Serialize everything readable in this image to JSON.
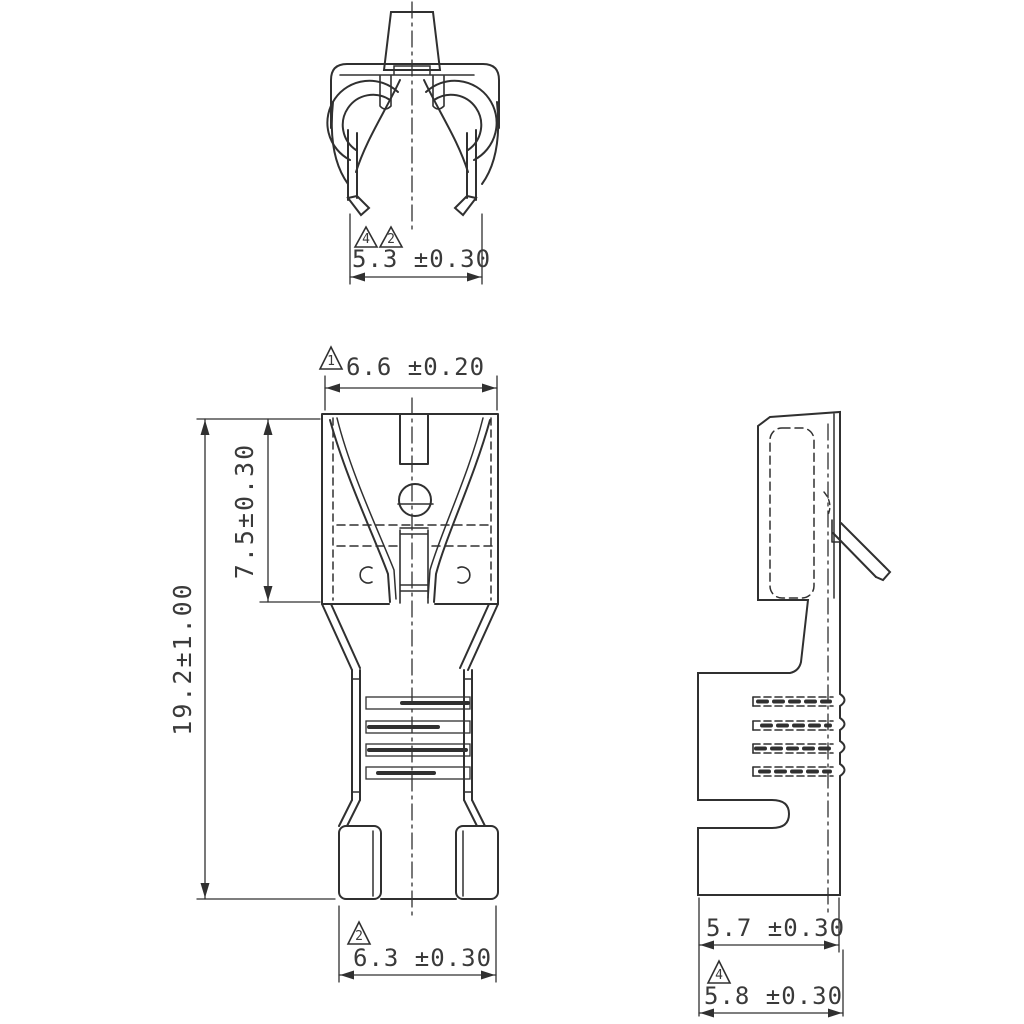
{
  "colors": {
    "background": "#ffffff",
    "line": "#303030",
    "text": "#3a3a3a"
  },
  "views": {
    "end_view": {
      "dim_width": {
        "text": "5.3 ±0.30",
        "flags": [
          "4",
          "2"
        ]
      }
    },
    "front_view": {
      "dim_top_width": {
        "text": "6.6 ±0.20",
        "flags": [
          "1"
        ]
      },
      "dim_contact_length": {
        "text": "7.5±0.30",
        "flags": []
      },
      "dim_overall_length": {
        "text": "19.2±1.00",
        "flags": []
      },
      "dim_bottom_width": {
        "text": "6.3 ±0.30",
        "flags": [
          "2"
        ]
      }
    },
    "side_view": {
      "dim_body_depth": {
        "text": "5.7 ±0.30",
        "flags": []
      },
      "dim_overall_depth": {
        "text": "5.8 ±0.30",
        "flags": [
          "4"
        ]
      }
    }
  }
}
